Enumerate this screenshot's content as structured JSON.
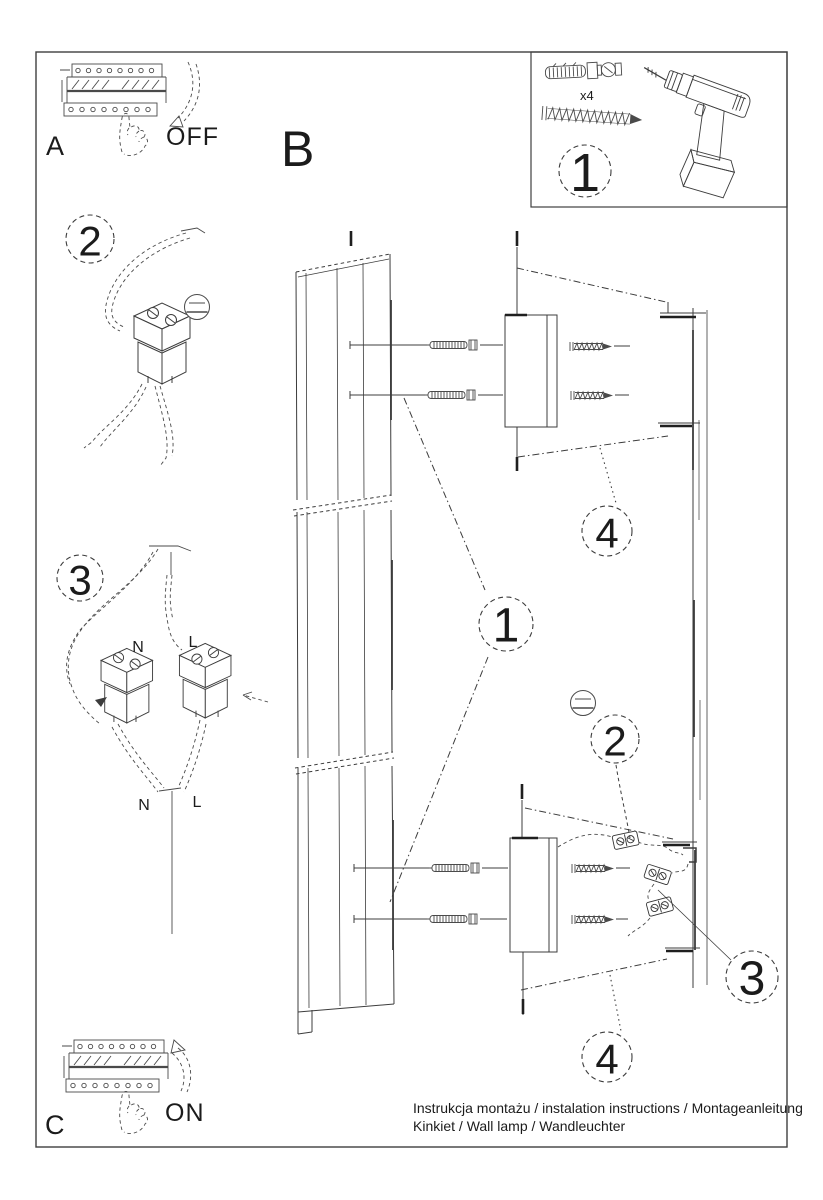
{
  "colors": {
    "paper": "#ffffff",
    "ink": "#1b1b1b",
    "sketch": "#4a4a4a"
  },
  "captions": {
    "line1": "Instrukcja montażu / instalation instructions / Montageanleitung",
    "line2": "Kinkiet / Wall lamp / Wandleuchter"
  },
  "panels": {
    "a": {
      "label": "A",
      "switch_state": "OFF"
    },
    "b": {
      "label": "B"
    },
    "c": {
      "label": "C",
      "switch_state": "ON"
    },
    "parts_box": {
      "step": "1",
      "anchor_qty": "x4"
    },
    "wiring_detail": {
      "step": "2"
    },
    "connection_detail": {
      "step": "3",
      "labels": {
        "n_top": "N",
        "l_top": "L",
        "n_bottom": "N",
        "l_bottom": "L"
      }
    }
  },
  "callouts": {
    "lamp_body": "1",
    "screwdriver_step": "2",
    "wiring_step": "3",
    "bracket_top": "4",
    "bracket_bottom": "4"
  }
}
